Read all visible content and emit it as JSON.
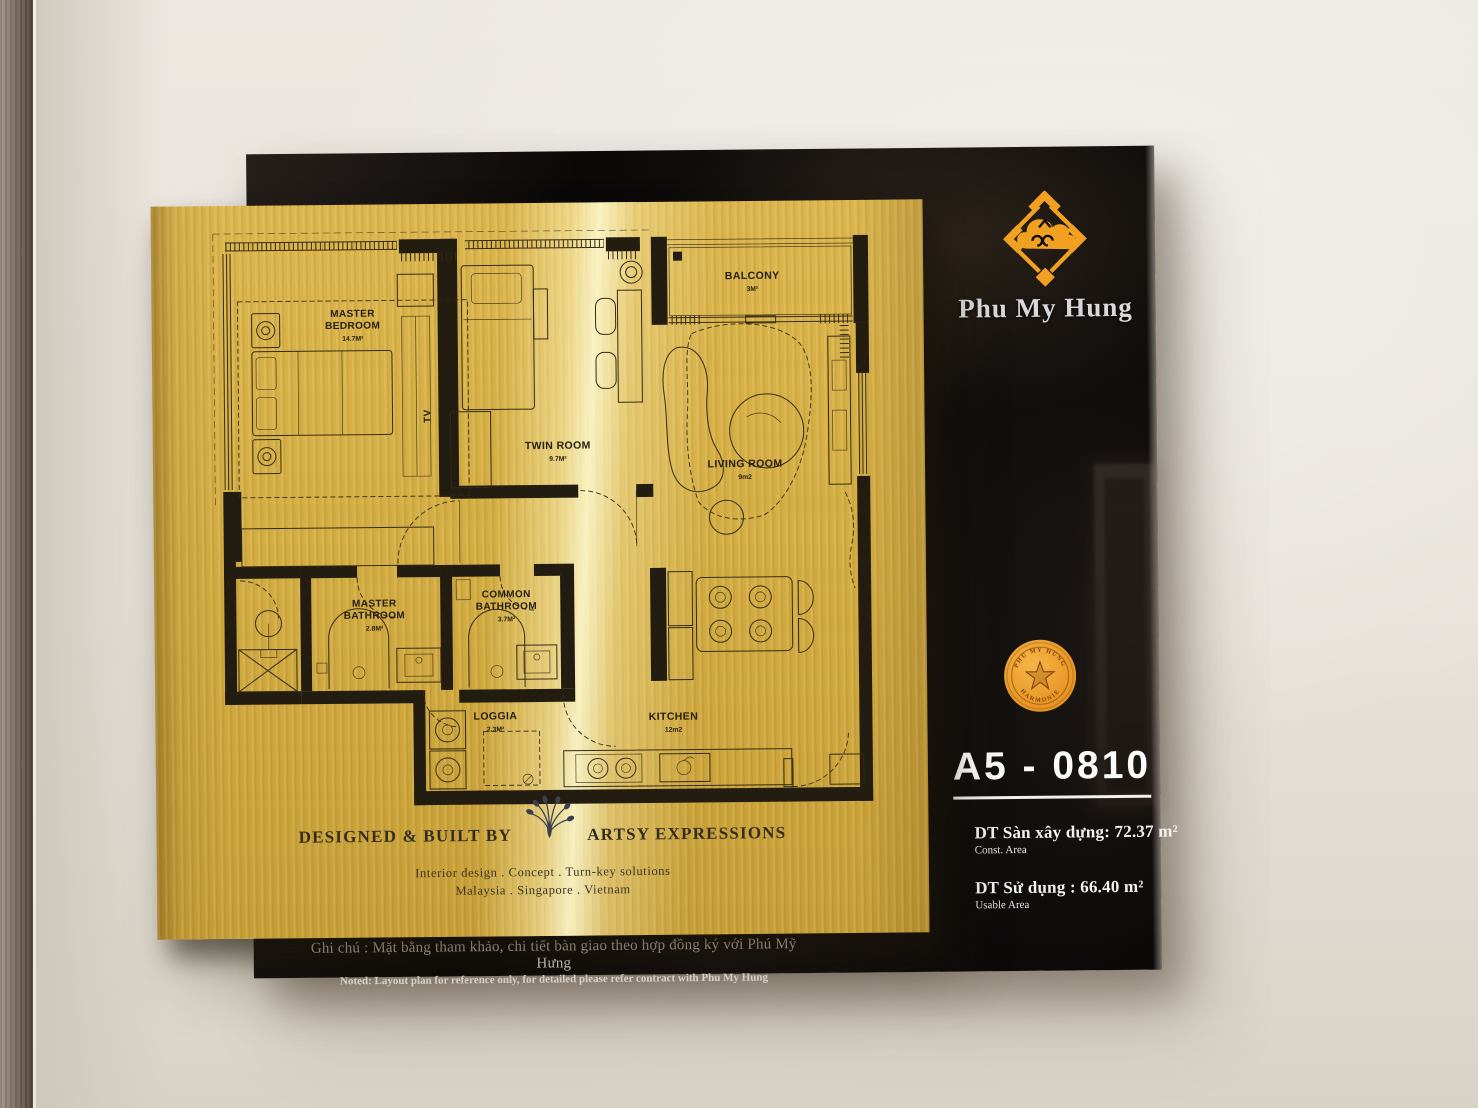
{
  "brand": {
    "wordmark": "Phu My Hung",
    "logo_color": "#f1a01f"
  },
  "seal": {
    "text_top": "PHU MY HUNG",
    "text_bottom": "HARMONIE",
    "color": "#ee9b26"
  },
  "unit": {
    "number": "A5 - 0810"
  },
  "areas": [
    {
      "label": "DT Sàn xây dựng:  72.37 m²",
      "sublabel": "Const. Area"
    },
    {
      "label": "DT Sử dụng :  66.40 m²",
      "sublabel": "Usable Area"
    }
  ],
  "floorplan": {
    "tv_label": "TV",
    "rooms": [
      {
        "line1": "MASTER",
        "line2": "BEDROOM",
        "area": "14.7M²"
      },
      {
        "line1": "TWIN ROOM",
        "line2": "",
        "area": "9.7M²"
      },
      {
        "line1": "BALCONY",
        "line2": "",
        "area": "3M²"
      },
      {
        "line1": "LIVING ROOM",
        "line2": "",
        "area": "9m2"
      },
      {
        "line1": "MASTER",
        "line2": "BATHROOM",
        "area": "2.8M²"
      },
      {
        "line1": "COMMON",
        "line2": "BATHROOM",
        "area": "3.7M²"
      },
      {
        "line1": "LOGGIA",
        "line2": "",
        "area": "2.3M²"
      },
      {
        "line1": "KITCHEN",
        "line2": "",
        "area": "12m2"
      }
    ]
  },
  "designer": {
    "prefix": "DESIGNED & BUILT BY",
    "name": "ARTSY EXPRESSIONS",
    "tagline": "Interior design . Concept . Turn-key solutions",
    "countries": "Malaysia . Singapore . Vietnam"
  },
  "note": {
    "vi": "Ghi chú : Mặt bằng tham khảo, chi tiết bàn giao theo hợp đồng ký với Phú Mỹ Hưng",
    "en": "Noted: Layout plan for reference only, for detailed please refer contract with Phu My Hung"
  }
}
